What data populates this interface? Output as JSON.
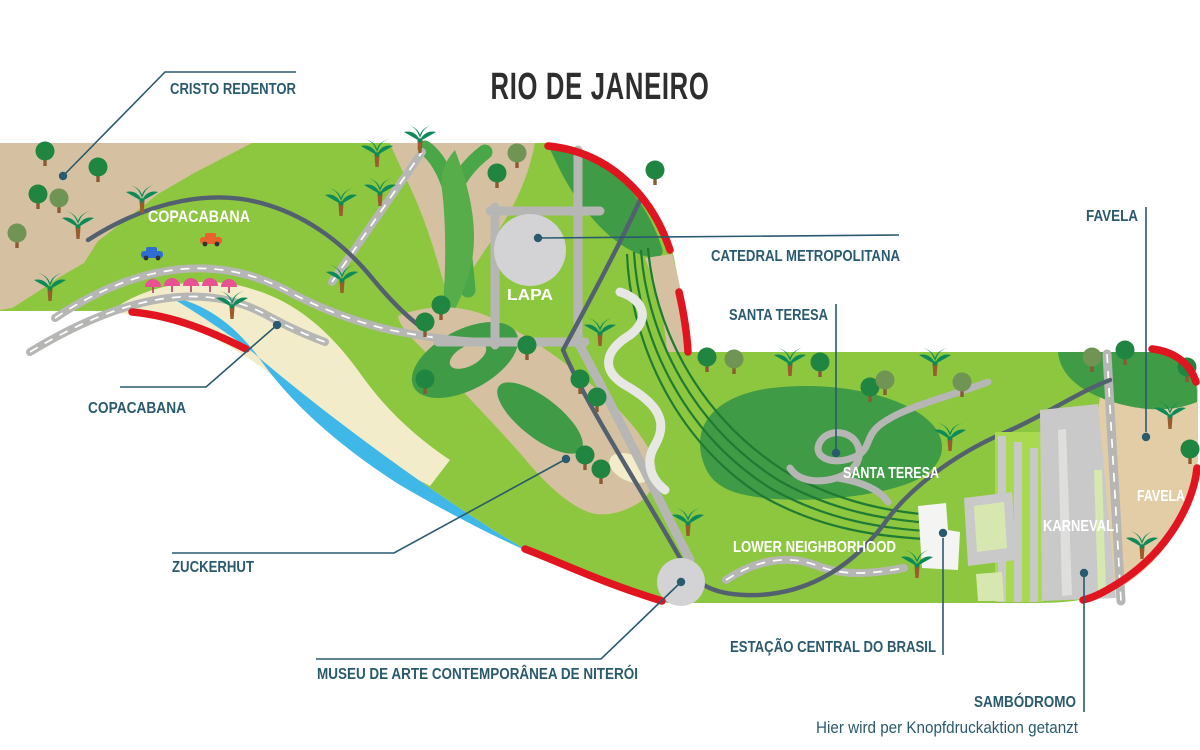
{
  "title": "RIO DE JANEIRO",
  "callout_labels": {
    "cristo_redentor": "CRISTO REDENTOR",
    "copacabana": "COPACABANA",
    "catedral_metropolitana": "CATEDRAL METROPOLITANA",
    "santa_teresa": "SANTA TERESA",
    "favela": "FAVELA",
    "zuckerhut": "ZUCKERHUT",
    "museu": "MUSEU DE ARTE CONTEMPORÂNEA DE NITERÓI",
    "estacao": "ESTAÇÃO CENTRAL DO BRASIL",
    "sambodromo": "SAMBÓDROMO",
    "sambodromo_note": "Hier wird per Knopfdruckaktion getanzt"
  },
  "area_labels": {
    "copacabana": "COPACABANA",
    "lapa": "LAPA",
    "santa_teresa": "SANTA TERESA",
    "favela": "FAVELA",
    "lower_neighborhood": "LOWER NEIGHBORHOOD",
    "karneval": "KARNEVAL"
  },
  "map_icons": [
    "palm-tree-icon",
    "tree-icon",
    "beach-umbrella-icon",
    "car-icon",
    "callout-dot-icon",
    "plaza-circle-icon",
    "museum-circle-icon"
  ],
  "colors": {
    "title_color": "#2e2e2e",
    "label_teal": "#2a5a6e",
    "land_green": "#8dc63f",
    "forest_green": "#3f9b45",
    "water_blue": "#3fb8e8",
    "sand": "#d5c1a1",
    "sand_warm": "#e3cda7",
    "beach": "#f3ecca",
    "road_gray": "#b6b6b4",
    "route_slate": "#53606f",
    "railway_green": "#1f7a33",
    "border_red": "#e01520",
    "structure_gray": "#c9c9c9",
    "umbrella_pink": "#e85290"
  }
}
